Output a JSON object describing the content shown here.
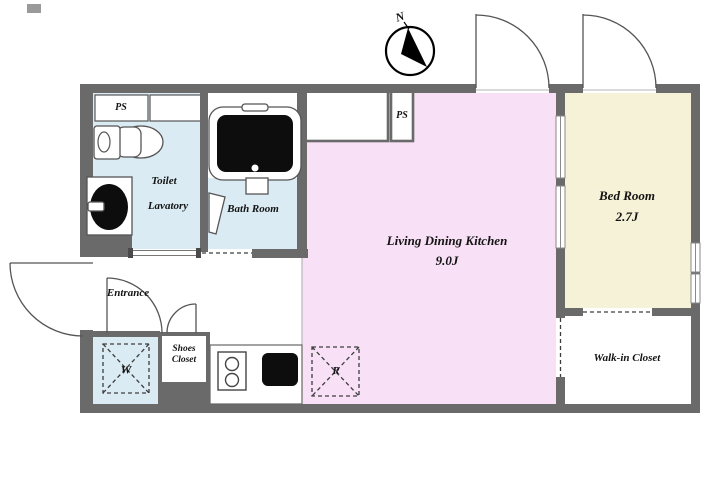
{
  "colors": {
    "wall": "#6a6a6a",
    "ldk_fill": "#f8e1f6",
    "bedroom_fill": "#f6f2d8",
    "wet_area_fill": "#daebf3",
    "outline": "#555555",
    "fixture_black": "#0d0d0d"
  },
  "compass": {
    "north_label": "N"
  },
  "rooms": {
    "ldk": {
      "name": "Living Dining Kitchen",
      "size": "9.0J"
    },
    "bedroom": {
      "name": "Bed Room",
      "size": "2.7J"
    },
    "toilet": {
      "name": "Toilet"
    },
    "lavatory": {
      "name": "Lavatory"
    },
    "bathroom": {
      "name": "Bath Room"
    },
    "entrance": {
      "name": "Entrance"
    },
    "shoes_closet": {
      "line1": "Shoes",
      "line2": "Closet"
    },
    "walk_in_closet": {
      "name": "Walk-in Closet"
    },
    "ps_lavatory": {
      "name": "PS"
    },
    "ps_kitchen": {
      "name": "PS"
    }
  },
  "appliances": {
    "washer_mark": "W",
    "refrigerator_mark": "R"
  }
}
